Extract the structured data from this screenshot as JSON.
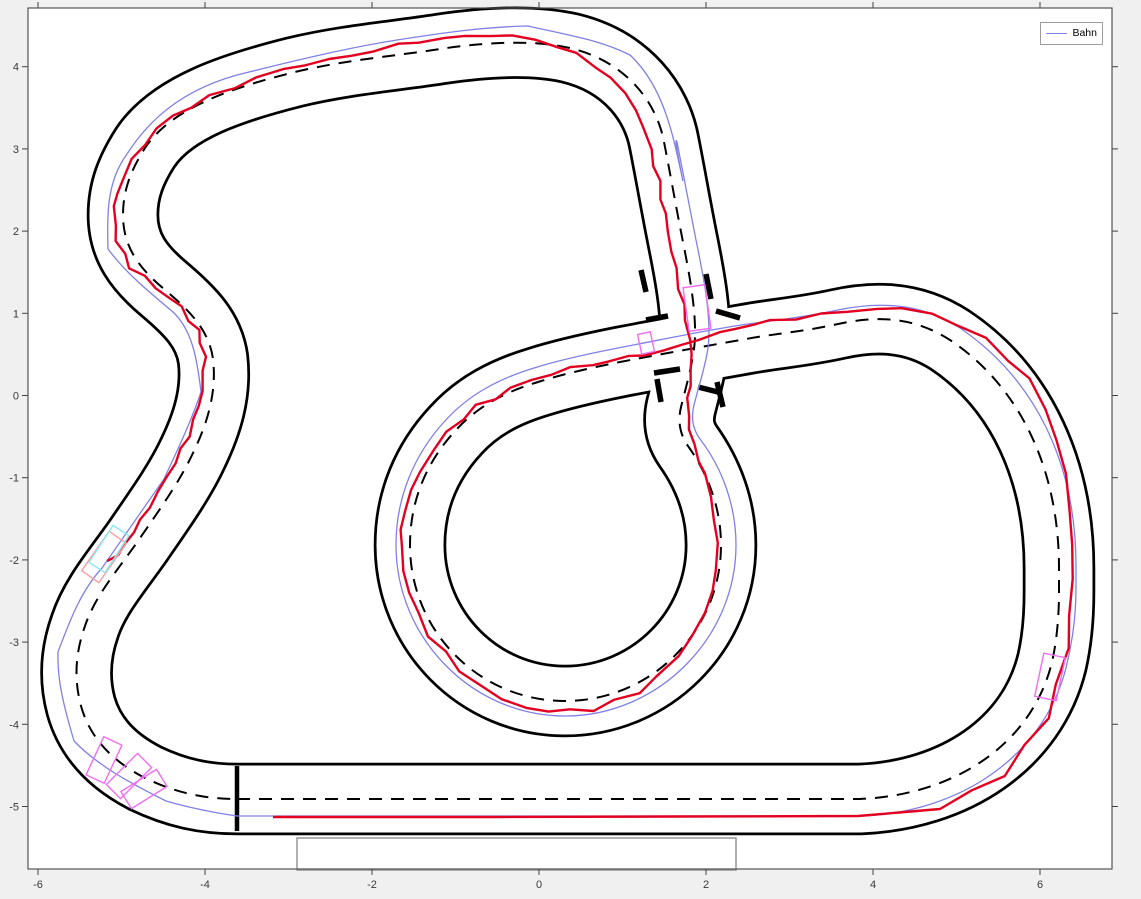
{
  "figure": {
    "background": "#f0f0f0",
    "plot_background": "#ffffff",
    "border_color": "#545454",
    "plot_box_px": {
      "left": 28,
      "top": 8,
      "right": 1112,
      "bottom": 869
    }
  },
  "legend": {
    "position": "top-right",
    "box_px": {
      "left": 1040,
      "top": 22,
      "width": 63,
      "height": 23
    },
    "entries": [
      {
        "label": "Bahn",
        "color": "#8080e8"
      }
    ]
  },
  "chart_data": {
    "type": "line",
    "title": "",
    "xlabel": "",
    "ylabel": "",
    "grid": false,
    "xlim": [
      -6.12,
      6.86
    ],
    "ylim": [
      -5.76,
      4.71
    ],
    "x_axis": {
      "tick_values": [
        -6,
        -4,
        -2,
        0,
        2,
        4,
        6
      ],
      "tick_labels": [
        "-6",
        "-4",
        "-2",
        "0",
        "2",
        "4",
        "6"
      ],
      "origin_px": 539,
      "px_per_unit": 83.5
    },
    "y_axis": {
      "tick_values": [
        4,
        3,
        2,
        1,
        0,
        -1,
        -2,
        -3,
        -4,
        -5
      ],
      "tick_labels": [
        "4",
        "3",
        "2",
        "1",
        "0",
        "-1",
        "-2",
        "-3",
        "-4",
        "-5"
      ],
      "origin_px": 395.5,
      "px_per_unit": 82.2
    },
    "tick_len": 6,
    "tick_color": "#424242",
    "tick_label_color": "#3a3a3a",
    "series": [
      {
        "name": "Bahn",
        "color": "#8080e8",
        "style": "solid thin",
        "role": "planned reference path"
      },
      {
        "name": "driven trajectory",
        "color": "#e40020",
        "style": "solid",
        "role": "measured vehicle path (start line to chicane)"
      },
      {
        "name": "track centerline",
        "color": "#000000",
        "style": "dashed",
        "role": "track center"
      },
      {
        "name": "track boundaries",
        "color": "#000000",
        "style": "solid",
        "role": "track edges, width 0.83 units"
      }
    ],
    "track": {
      "road_width_px": 67,
      "casing_width_px": 72.5,
      "boundary_color": "#000000",
      "road_color": "#ffffff",
      "center_dash": "13 9",
      "centerline_path": "M 237 799 L 860 799 C 955 795 1032 744 1052 662 C 1057 640 1059 615 1059 592 L 1059 568 C 1059 472 1022 388 950 340 C 910 314 870 317 838 324 C 802 332 772 334 746 339 C 712 345 672 352 620 362 C 585 369 560 375 538 382 C 505 392 478 406 456 430 C 427 461 410 500 410 545 C 410 631 479 701 565 701 C 651 701 721 631 721 545 C 721 508 708 474 688 446 C 679 433 678 420 681 407 C 686 387 691 370 694 349 C 698 320 690 277 683 242 C 676 207 670 172 664 142 C 657 104 628 62 570 48 C 530 39 480 43 440 49 C 395 56 345 60 295 72 C 235 87 172 107 145 148 C 131 170 123 190 123 215 C 123 247 139 268 164 289 C 190 311 209 330 213 359 C 217 393 207 424 193 453 C 180 481 160 509 138 541 C 117 571 95 596 85 626 C 75 654 74 680 81 706 C 90 738 112 761 145 778 C 176 793 205 799 237 799 Z",
      "bahn_path": "M 237 816 L 862 816 C 960 812 1043 757 1066 668 C 1073 640 1076 612 1076 588 L 1076 566 C 1076 464 1036 380 960 328 C 917 300 872 303 838 310 C 800 318 770 321 748 324 C 712 329 670 338 618 348 C 582 355 556 361 534 368 C 498 379 468 395 444 422 C 414 455 396 498 396 545 C 396 638 472 716 565 716 C 658 716 736 638 736 545 C 736 505 722 468 700 439 C 692 428 691 417 694 405 C 699 385 705 368 708 348 C 712 318 703 274 696 240 C 689 205 683 172 677 142 C 672 130 688 205 681 172 C 672 130 662 85 630 55 C 600 40 572 36 528 26 C 482 27 442 33 397 40 C 347 48 297 60 237 75 C 165 95 138 137 123 160 C 107 186 107 215 108 249 C 124 271 149 292 173 312 C 192 330 197 358 201 392 C 191 422 177 451 164 479 C 145 506 123 538 102 568 C 80 592 69 623 58 652 C 57 680 64 707 74 741 C 98 766 132 784 166 801 C 200 811 237 816 237 816 Z",
      "trajectory_points": [
        [
          273,
          817
        ],
        [
          500,
          817
        ],
        [
          858,
          816
        ],
        [
          940,
          809
        ],
        [
          1005,
          775
        ],
        [
          1048,
          717
        ],
        [
          1068,
          650
        ],
        [
          1073,
          580
        ],
        [
          1071,
          510
        ],
        [
          1058,
          440
        ],
        [
          1030,
          380
        ],
        [
          985,
          338
        ],
        [
          930,
          313
        ],
        [
          875,
          308
        ],
        [
          820,
          314
        ],
        [
          770,
          322
        ],
        [
          736,
          328
        ],
        [
          700,
          338
        ],
        [
          664,
          352
        ],
        [
          628,
          357
        ],
        [
          592,
          364
        ],
        [
          552,
          374
        ],
        [
          512,
          388
        ],
        [
          478,
          406
        ],
        [
          448,
          432
        ],
        [
          420,
          470
        ],
        [
          404,
          510
        ],
        [
          400,
          548
        ],
        [
          408,
          592
        ],
        [
          428,
          635
        ],
        [
          460,
          672
        ],
        [
          502,
          700
        ],
        [
          548,
          712
        ],
        [
          592,
          710
        ],
        [
          638,
          692
        ],
        [
          678,
          658
        ],
        [
          706,
          614
        ],
        [
          718,
          568
        ],
        [
          716,
          520
        ],
        [
          706,
          475
        ],
        [
          694,
          444
        ],
        [
          688,
          415
        ],
        [
          690,
          385
        ],
        [
          692,
          355
        ],
        [
          686,
          322
        ],
        [
          679,
          288
        ],
        [
          671,
          250
        ],
        [
          664,
          215
        ],
        [
          658,
          182
        ],
        [
          650,
          148
        ],
        [
          636,
          110
        ],
        [
          612,
          78
        ],
        [
          578,
          54
        ],
        [
          536,
          40
        ],
        [
          490,
          34
        ],
        [
          444,
          38
        ],
        [
          398,
          46
        ],
        [
          352,
          55
        ],
        [
          306,
          64
        ],
        [
          258,
          78
        ],
        [
          210,
          96
        ],
        [
          172,
          116
        ],
        [
          143,
          144
        ],
        [
          122,
          176
        ],
        [
          113,
          208
        ],
        [
          116,
          242
        ],
        [
          130,
          266
        ],
        [
          156,
          288
        ],
        [
          181,
          308
        ],
        [
          198,
          330
        ],
        [
          205,
          356
        ],
        [
          203,
          390
        ],
        [
          195,
          420
        ],
        [
          183,
          450
        ],
        [
          167,
          478
        ],
        [
          150,
          506
        ],
        [
          133,
          534
        ],
        [
          117,
          556
        ],
        [
          107,
          561
        ]
      ],
      "start_finish_line": {
        "x1": 237,
        "y1": 766,
        "x2": 237,
        "y2": 831,
        "width": 4.5,
        "color": "#000000"
      },
      "crossing_end_bars": [
        {
          "x1": 646,
          "y1": 320,
          "x2": 668,
          "y2": 316
        },
        {
          "x1": 654,
          "y1": 373,
          "x2": 680,
          "y2": 369
        },
        {
          "x1": 716,
          "y1": 311,
          "x2": 740,
          "y2": 318
        },
        {
          "x1": 698,
          "y1": 387,
          "x2": 722,
          "y2": 393
        },
        {
          "x1": 641,
          "y1": 270,
          "x2": 646,
          "y2": 292
        },
        {
          "x1": 706,
          "y1": 274,
          "x2": 711,
          "y2": 299
        },
        {
          "x1": 657,
          "y1": 379,
          "x2": 661,
          "y2": 402
        },
        {
          "x1": 717,
          "y1": 382,
          "x2": 723,
          "y2": 407
        }
      ],
      "bar_width": 5.5,
      "staging_box": {
        "x": 297,
        "y": 838,
        "w": 439,
        "h": 32,
        "color": "#8f8f8f"
      },
      "vehicle_boxes": [
        {
          "cx": 697,
          "cy": 308,
          "w": 22,
          "h": 44,
          "angle": -8,
          "color": "#f26df2"
        },
        {
          "cx": 646,
          "cy": 343,
          "w": 13,
          "h": 20,
          "angle": -12,
          "color": "#f26df2"
        },
        {
          "cx": 104,
          "cy": 557,
          "w": 21,
          "h": 48,
          "angle": 35,
          "color": "#ff9a9a"
        },
        {
          "cx": 109,
          "cy": 549,
          "w": 19,
          "h": 44,
          "angle": 33,
          "color": "#86e8f5"
        },
        {
          "cx": 104,
          "cy": 760,
          "w": 20,
          "h": 42,
          "angle": 25,
          "color": "#f26df2"
        },
        {
          "cx": 129,
          "cy": 776,
          "w": 20,
          "h": 44,
          "angle": 45,
          "color": "#f26df2"
        },
        {
          "cx": 144,
          "cy": 789,
          "w": 20,
          "h": 42,
          "angle": 58,
          "color": "#f26df2"
        },
        {
          "cx": 1050,
          "cy": 677,
          "w": 22,
          "h": 44,
          "angle": 12,
          "color": "#f26df2"
        }
      ],
      "bahn_color": "#8080e8",
      "bahn_width": 1.3,
      "trajectory_color": "#e40020",
      "trajectory_width": 2.4
    }
  }
}
